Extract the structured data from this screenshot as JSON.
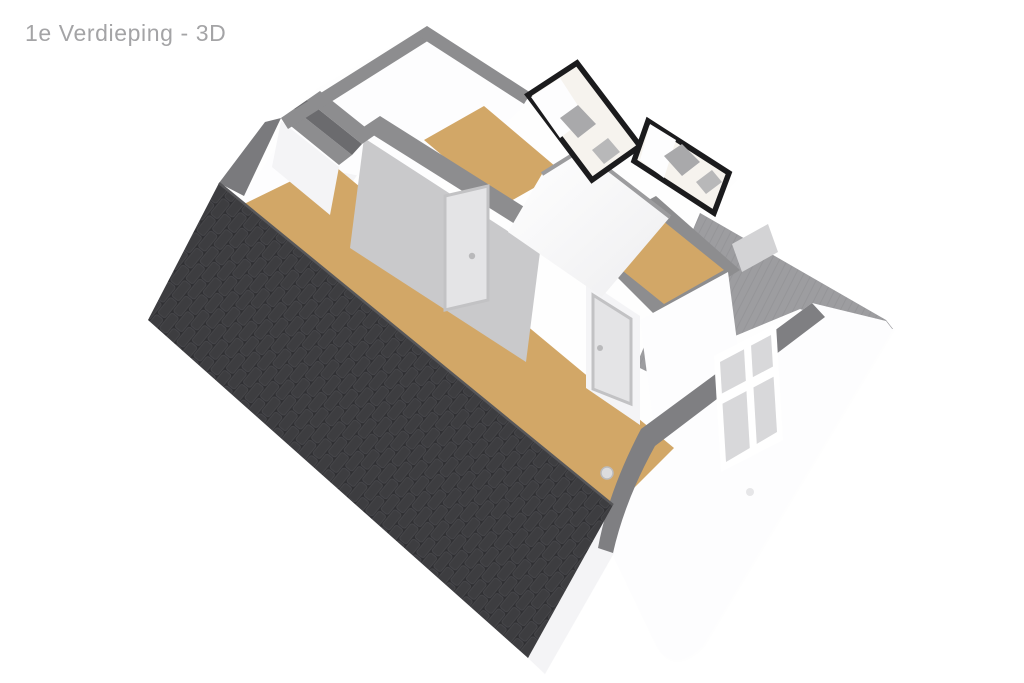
{
  "title": {
    "text": "1e Verdieping - 3D"
  },
  "page": {
    "background": "#ffffff"
  },
  "colors": {
    "bg": "#ffffff",
    "title": "#a4a4a6",
    "wall-top": "#8d8d8f",
    "wall-top-dark": "#7a7a7d",
    "wall-lit": "#fdfdfe",
    "wall-light": "#f4f4f6",
    "wall-mid": "#d3d3d5",
    "wall-shade": "#c9c9cb",
    "floor": "#d2a767",
    "roof-base": "#303033",
    "roof-tile": "#3d3d40",
    "roof-tile-edge": "#48484c",
    "roof-ridge": "#57575a",
    "roof-gray": "#9d9da0",
    "roof-gray-line": "#8f8f92",
    "eave": "#7f7f82",
    "frame-black": "#1b1b1d",
    "glass": "#f6f3ee",
    "sill": "#a9a9ab",
    "door": "#e4e4e6",
    "door-frame": "#c2c2c4",
    "window-inner": "#d8d8da"
  },
  "scene": {
    "kind": "3d-floorplan-cutaway",
    "floor_label": "1e Verdieping",
    "view_mode": "3D",
    "parts": [
      "dark-tiled-roof",
      "left-gable",
      "back-wall",
      "hallway-floor",
      "small-room-floor",
      "middle-room-floor",
      "interior-door-1",
      "interior-door-2",
      "stair-bulkhead",
      "dormer-window-bay-1",
      "dormer-window-bay-2",
      "right-roof-plane",
      "eave-band",
      "right-gable-wall",
      "gable-window",
      "wall-vent"
    ]
  }
}
